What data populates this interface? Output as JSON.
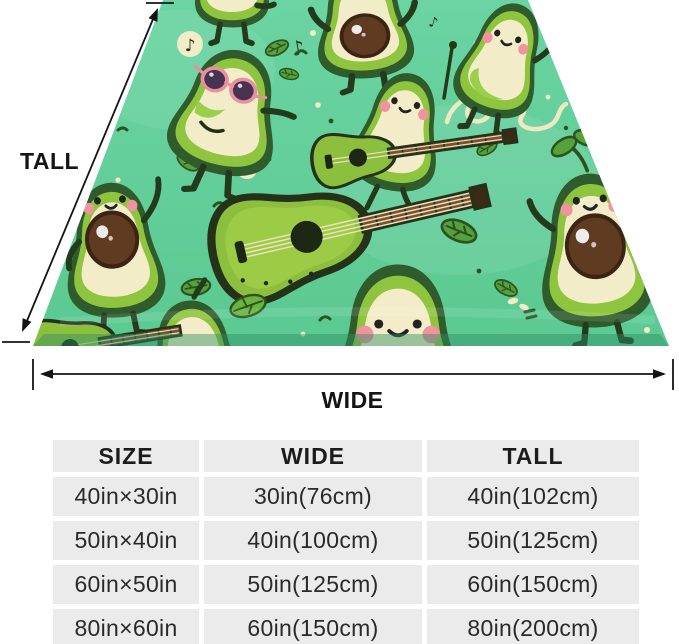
{
  "preview": {
    "tall_label": "TALL",
    "wide_label": "WIDE",
    "music_note_glyph": "♪",
    "scene": "Perspective view of a mint-green blanket printed with cartoon avocado characters (one wearing pink sunglasses, some playing guitars), avocado-shaped guitars, leaves, cream dots, music notes and a looping doodle",
    "colors": {
      "blanket_green": "#63cf9b",
      "avocado_skin": "#2f5b2d",
      "avocado_rim": "#8fc43e",
      "avocado_flesh": "#f2edc8",
      "pit_brown": "#5f3b22",
      "cheek_pink": "#f1939f",
      "sunglasses_pink": "#e98fa0",
      "guitar_green": "#8cbf3e",
      "guitar_neck_brown": "#7c4f2d",
      "leaf_green": "#55a23a",
      "doodle_cream": "#efe9c3",
      "arrow_black": "#141414"
    }
  },
  "size_table": {
    "headers": [
      "SIZE",
      "WIDE",
      "TALL"
    ],
    "rows": [
      [
        "40in×30in",
        "30in(76cm)",
        "40in(102cm)"
      ],
      [
        "50in×40in",
        "40in(100cm)",
        "50in(125cm)"
      ],
      [
        "60in×50in",
        "50in(125cm)",
        "60in(150cm)"
      ],
      [
        "80in×60in",
        "60in(150cm)",
        "80in(200cm)"
      ]
    ],
    "cell_background": "#ebebeb",
    "text_color": "#2a2a2a"
  }
}
